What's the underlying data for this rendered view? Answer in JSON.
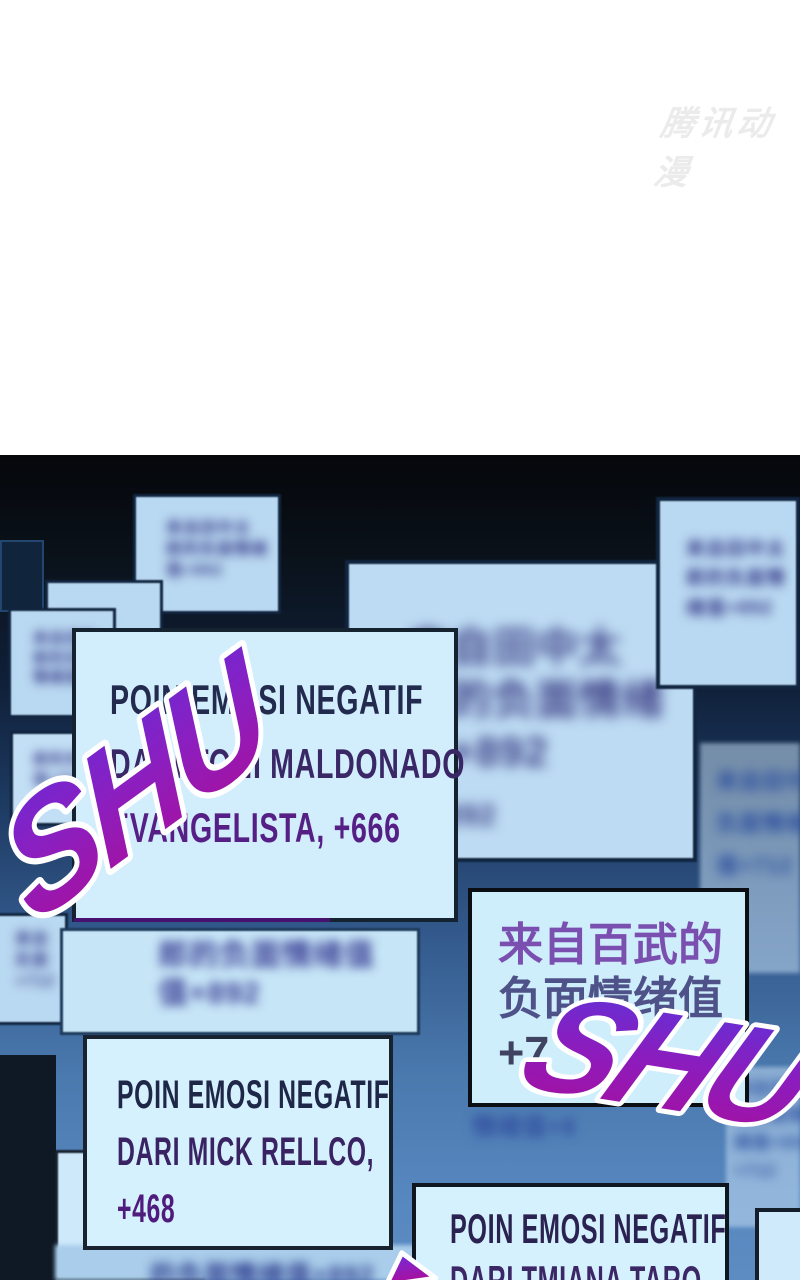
{
  "page": {
    "watermark": "腾讯动漫"
  },
  "sfx": {
    "shu_left": "SHU",
    "shu_right": "SHU"
  },
  "notifications": {
    "maldonado": {
      "lines": [
        "POIN EMOSI NEGATIF",
        "DARI TONI MALDONADO",
        "EVANGELISTA, +666"
      ]
    },
    "baiwu": {
      "lines": [
        "来自百武的",
        "负面情绪值",
        "+7"
      ]
    },
    "mick": {
      "lines": [
        "POIN EMOSI NEGATIF",
        "DARI MICK RELLCO,",
        "+468"
      ]
    },
    "taro": {
      "lines": [
        "POIN EMOSI NEGATIF",
        "DARI TMIANA TARO"
      ]
    }
  },
  "background_notifications": {
    "cn_top_small": {
      "lines": [
        "来自田中太",
        "郎的负面情绪",
        "值+892"
      ]
    },
    "cn_left_upper": {
      "lines": [
        "来自田中",
        "郎的负面",
        "情绪值+8"
      ]
    },
    "cn_left_mid": {
      "lines": [
        "郎的负",
        "值+892"
      ]
    },
    "cn_big_center": {
      "lines": [
        "来自田中太",
        "郎的负面情绪",
        "值+892"
      ],
      "extra": "值+892"
    },
    "cn_right_top": {
      "lines": [
        "来自田中太",
        "郎的负面情",
        "绪值+892"
      ]
    },
    "cn_right_mid": {
      "lines": [
        "来自田中",
        "负面情绪",
        "值+712"
      ]
    },
    "cn_left_lower": {
      "lines": [
        "来自",
        "负面",
        "+712"
      ]
    },
    "cn_under_main": {
      "lines": [
        "郎的负面情绪值",
        "值+892"
      ]
    },
    "cn_below_baiwu": {
      "lines": [
        "情绪值+8"
      ]
    },
    "cn_right_bottom": {
      "lines": [
        "来自田中",
        "的负面情",
        "绪值+892",
        "+712"
      ]
    },
    "cn_bottom_bar": {
      "lines": [
        "的负面情绪值+892"
      ]
    }
  },
  "colors": {
    "box_fill": "#d5f0fd",
    "sfx_gradient_top": "#6b2ad6",
    "sfx_gradient_bottom": "#a90f9c",
    "panel_bottom_blue": "#5d8cc2",
    "text_navy": "#222a4e",
    "text_purple": "#561f86"
  }
}
